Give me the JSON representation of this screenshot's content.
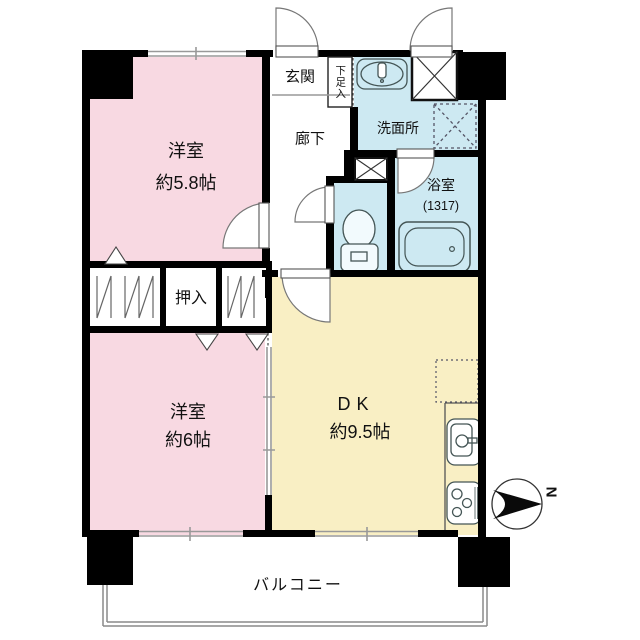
{
  "rooms": {
    "western_room_1": {
      "label": "洋室",
      "size": "約5.8帖"
    },
    "western_room_2": {
      "label": "洋室",
      "size": "約6帖"
    },
    "dining_kitchen": {
      "label": "DK",
      "size": "約9.5帖"
    },
    "entrance": {
      "label": "玄関"
    },
    "shoe_storage": {
      "label": "下足入"
    },
    "hallway": {
      "label": "廊下"
    },
    "washroom": {
      "label": "洗面所"
    },
    "bathroom": {
      "label": "浴室",
      "size": "(1317)"
    },
    "closet": {
      "label": "押入"
    },
    "balcony": {
      "label": "バルコニー"
    }
  },
  "compass": {
    "north_label": "N"
  },
  "colors": {
    "wall": "#000000",
    "western_room": "#f8d9e2",
    "dining_kitchen": "#f9efc4",
    "wet_area": "#cde9f2",
    "window_line": "#999999"
  },
  "icons": [
    "compass-icon",
    "washbasin-icon",
    "toilet-icon",
    "bathtub-icon",
    "kitchen-sink-icon",
    "stove-icon",
    "refrigerator-space",
    "washing-machine-space",
    "meter-box",
    "pipe-shaft",
    "door-swing-icon",
    "window-mark",
    "closet-hatch"
  ]
}
